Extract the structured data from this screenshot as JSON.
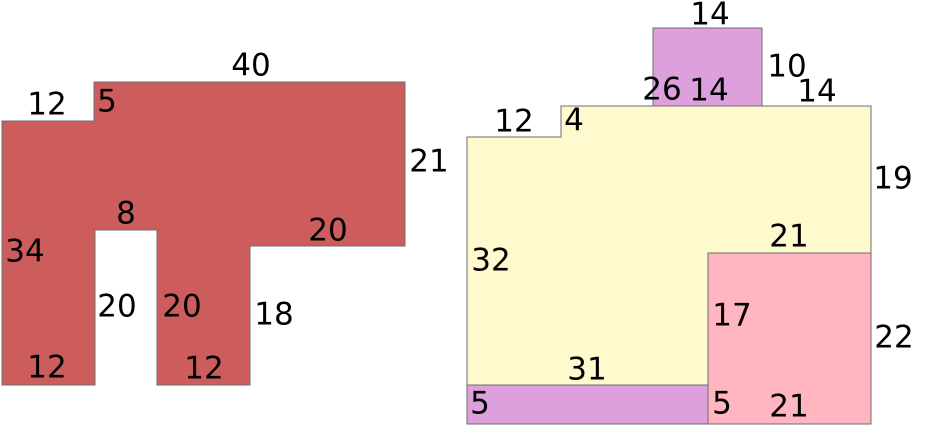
{
  "canvas": {
    "width": 925,
    "height": 435,
    "background": "#ffffff"
  },
  "style": {
    "stroke_color": "#6e6e6e",
    "stroke_width": 1,
    "label_color": "#000000",
    "label_font_size": 31
  },
  "figures": [
    {
      "name": "left-composite-figure",
      "shapes": [
        {
          "id": "red-polygon",
          "type": "polygon",
          "fill": "#cd5c5c",
          "points": [
            [
              94,
              82
            ],
            [
              405,
              82
            ],
            [
              405,
              246
            ],
            [
              250,
              246
            ],
            [
              250,
              385
            ],
            [
              157,
              385
            ],
            [
              157,
              230
            ],
            [
              95,
              230
            ],
            [
              95,
              385
            ],
            [
              2,
              385
            ],
            [
              2,
              121
            ],
            [
              94,
              121
            ]
          ]
        }
      ],
      "labels": [
        {
          "id": "top-width-40",
          "text": "40",
          "x": 251,
          "y": 66
        },
        {
          "id": "upper-left-width-12",
          "text": "12",
          "x": 47,
          "y": 105
        },
        {
          "id": "step-height-5",
          "text": "5",
          "x": 107,
          "y": 102
        },
        {
          "id": "right-height-21",
          "text": "21",
          "x": 429,
          "y": 162
        },
        {
          "id": "arm-bottom-width-20",
          "text": "20",
          "x": 328,
          "y": 231
        },
        {
          "id": "notch-top-width-8",
          "text": "8",
          "x": 126,
          "y": 214
        },
        {
          "id": "left-height-34",
          "text": "34",
          "x": 25,
          "y": 252
        },
        {
          "id": "notch-left-height-20",
          "text": "20",
          "x": 117,
          "y": 307
        },
        {
          "id": "notch-right-height-20",
          "text": "20",
          "x": 182,
          "y": 307
        },
        {
          "id": "inner-right-height-18",
          "text": "18",
          "x": 274,
          "y": 315
        },
        {
          "id": "bottom-left-width-12",
          "text": "12",
          "x": 47,
          "y": 368
        },
        {
          "id": "bottom-middle-width-12",
          "text": "12",
          "x": 204,
          "y": 369
        }
      ]
    },
    {
      "name": "right-composite-figure",
      "shapes": [
        {
          "id": "yellow-polygon",
          "type": "polygon",
          "fill": "#fffacd",
          "points": [
            [
              467,
              137
            ],
            [
              561,
              137
            ],
            [
              561,
              106
            ],
            [
              871,
              106
            ],
            [
              871,
              253
            ],
            [
              708,
              253
            ],
            [
              708,
              385
            ],
            [
              467,
              385
            ]
          ]
        },
        {
          "id": "plum-top-rectangle",
          "type": "rect",
          "fill": "#dda0dd",
          "x": 653,
          "y": 28,
          "width": 109,
          "height": 78
        },
        {
          "id": "pink-rectangle",
          "type": "rect",
          "fill": "#ffb6c1",
          "x": 708,
          "y": 253,
          "width": 163,
          "height": 171
        },
        {
          "id": "plum-bottom-strip",
          "type": "rect",
          "fill": "#dda0dd",
          "x": 467,
          "y": 385,
          "width": 241,
          "height": 39
        }
      ],
      "labels": [
        {
          "id": "plum-top-width-14",
          "text": "14",
          "x": 710,
          "y": 15
        },
        {
          "id": "plum-right-height-10",
          "text": "10",
          "x": 787,
          "y": 67
        },
        {
          "id": "top-edge-left-26",
          "text": "26",
          "x": 662,
          "y": 90
        },
        {
          "id": "plum-bottom-width-14",
          "text": "14",
          "x": 709,
          "y": 91
        },
        {
          "id": "top-edge-right-14",
          "text": "14",
          "x": 817,
          "y": 92
        },
        {
          "id": "upper-left-width-12",
          "text": "12",
          "x": 514,
          "y": 122
        },
        {
          "id": "step-height-4",
          "text": "4",
          "x": 574,
          "y": 121
        },
        {
          "id": "right-height-19",
          "text": "19",
          "x": 893,
          "y": 179
        },
        {
          "id": "pink-top-width-21",
          "text": "21",
          "x": 789,
          "y": 237
        },
        {
          "id": "left-height-32",
          "text": "32",
          "x": 491,
          "y": 261
        },
        {
          "id": "yellow-bottom-width-31",
          "text": "31",
          "x": 587,
          "y": 370
        },
        {
          "id": "pink-left-height-17",
          "text": "17",
          "x": 732,
          "y": 316
        },
        {
          "id": "pink-right-height-22",
          "text": "22",
          "x": 894,
          "y": 338
        },
        {
          "id": "pink-bottom-width-21",
          "text": "21",
          "x": 789,
          "y": 407
        },
        {
          "id": "strip-left-height-5",
          "text": "5",
          "x": 480,
          "y": 404
        },
        {
          "id": "pink-lower-left-height-5",
          "text": "5",
          "x": 722,
          "y": 404
        }
      ]
    }
  ]
}
